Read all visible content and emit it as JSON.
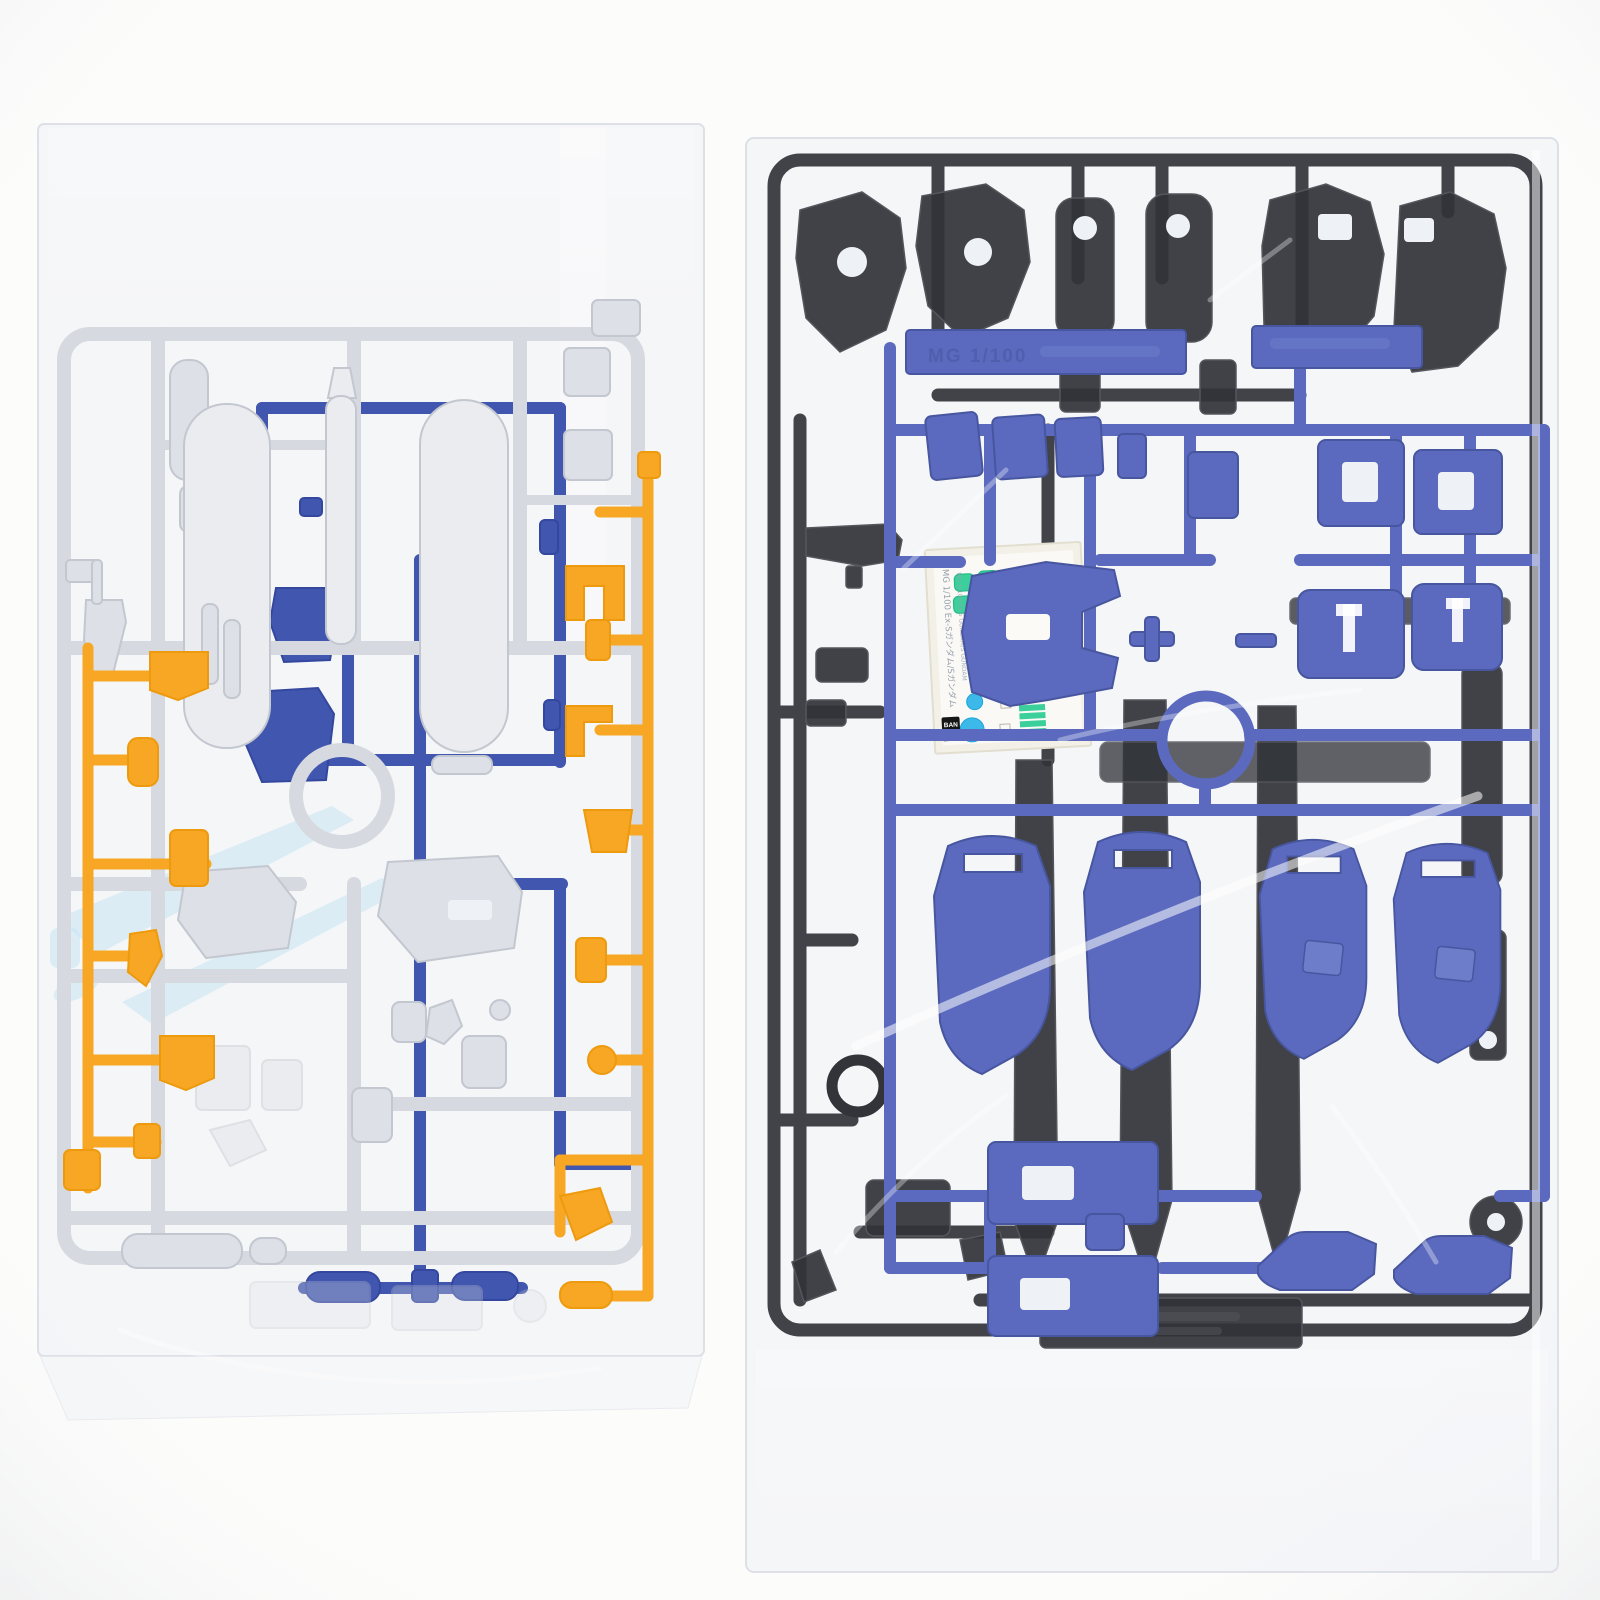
{
  "colors": {
    "photo_bg": "#fcfcfb",
    "bag_tint": "#eef1f5",
    "bag_edge": "#dde1e7",
    "gray_runner": "#d6d9df",
    "gray_part": "#dde0e6",
    "gray_part_lt": "#eaecf0",
    "gray_part_edge": "#c3c7cf",
    "orange": "#f7a723",
    "orange_deep": "#ee9a0e",
    "blue_left": "#4156ae",
    "blue_left_deep": "#33479e",
    "clear_blue": "#c9e6f4",
    "dark_runner": "#414348",
    "dark_part": "#323439",
    "dark_part_light": "#54565c",
    "blue_right": "#5b6abf",
    "blue_right_light": "#6e7dca",
    "blue_right_deep": "#47569f",
    "sticker_paper": "#f3f1e7",
    "sticker_green": "#3bcf9b",
    "sticker_green_deep": "#17b97f",
    "sticker_cyan": "#3cb9e8",
    "sticker_cyan_deep": "#1ea5dc",
    "crease": "rgba(255,255,255,0.55)"
  },
  "scene": {
    "left_bag": "clear bag with light gray, royal blue, orange and clear-blue runners",
    "right_bag": "clear bag with dark gray runner, periwinkle blue runner and sticker sheet"
  },
  "sticker_sheet": {
    "line_jp": "MG 1/100 Ex-Sガンダム/Sガンダム",
    "line_en": "MG 1/100 Ex-S GUNDAM/S GUNDAM",
    "brand_line1": "BAN",
    "brand_line2": "DAI"
  },
  "molded_labels": {
    "blue_tab": "MG 1/100"
  }
}
